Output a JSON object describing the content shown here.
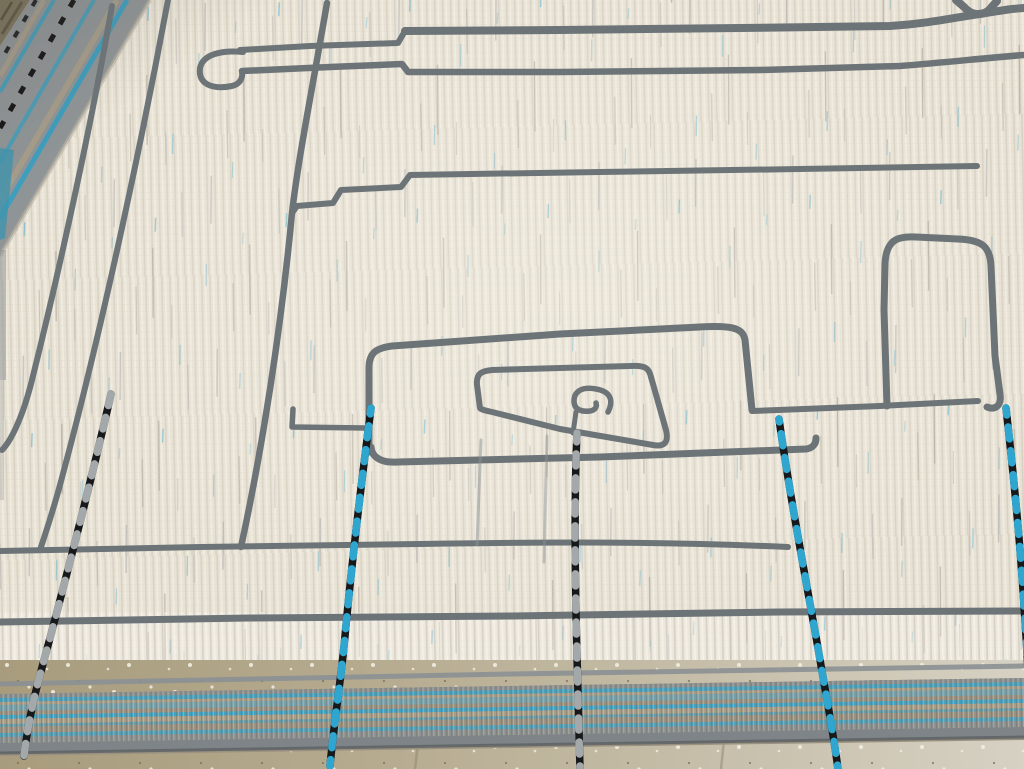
{
  "scene": {
    "type": "photograph",
    "subject": "Cream wool Moroccan-style rug with charcoal abstract meander lines, seen at an angle; blue-and-black braided cords hang across it; flat-woven blue-striped end band; speckled stone floor along the bottom edge",
    "view": "close-up, rug fills the frame, floor visible at bottom"
  },
  "colors": {
    "field": "#e8e2d5",
    "field_rib_shadow": "#c8c1b1",
    "field_rib_light": "#f7f3e9",
    "line": "#6d7478",
    "line_soft": "#8b9195",
    "edge_gray": "#8b9094",
    "cord_black": "#17181a",
    "cord_blue": "#2ea6cf",
    "cord_gray": "#a3a8ab",
    "band_base": "#9a9181",
    "band_blue": "#3aa4c8",
    "band_blue_soft": "#6fa4b5",
    "band_tan": "#a99e88",
    "band_gray": "#8a8f90",
    "band_binding": "#7e8487",
    "band_binding_dark": "#5c6164",
    "border_base": "#8f9496",
    "border_blue": "#35a0c2",
    "border_tan": "#a59c8a",
    "border_black": "#141414",
    "fringe": "#7a7259",
    "floor_left": "#a89c7d",
    "floor_mid": "#b5aa8e",
    "floor_right": "#d6d1c3",
    "speckle": "#f1eee4",
    "grout": "#8f8674",
    "fleck_blue": "#4aa8c8"
  },
  "objects": {
    "rug_field": "ivory cut-pile field with vertical rib texture, scattered blue and taupe flecks",
    "meander_motifs": [
      "long double line with rounded loop end (top)",
      "stepped long horizontal line (upper middle)",
      "three parallel diagonal lines (upper left)",
      "large rounded spiral with inner box and curl (center)",
      "tall narrow arch on a base line (right)",
      "two long horizontal lines (lower field)",
      "small dark hook at top-right corner"
    ],
    "braided_cords": {
      "count": 5,
      "pattern": "chevron braid, hanging vertically onto the floor",
      "colorways": [
        "gray and black",
        "blue and black",
        "gray and black",
        "blue and black",
        "blue and black"
      ]
    },
    "left_border": "flat-woven selvedge band: gray with blue stripes, black dashed braid, olive fringe at the corner",
    "bottom_band": "flat-woven end band: blue stripes over tan-gray ribbing with gray braided binding",
    "floor": "terrazzo-like stone, olive-tan at left fading to pale gray at right, white speckles, faint grout lines"
  }
}
